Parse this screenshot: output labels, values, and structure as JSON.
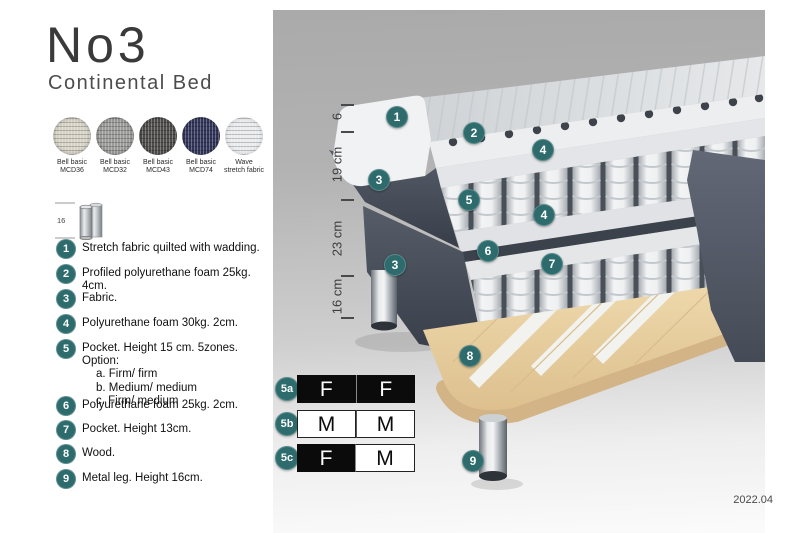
{
  "title": "No3",
  "subtitle": "Continental Bed",
  "swatches": [
    {
      "line1": "Bell basic",
      "line2": "MCD36",
      "color": "#d6d2c6"
    },
    {
      "line1": "Bell basic",
      "line2": "MCD32",
      "color": "#9b9b99"
    },
    {
      "line1": "Bell basic",
      "line2": "MCD43",
      "color": "#4e4d4b"
    },
    {
      "line1": "Bell basic",
      "line2": "MCD74",
      "color": "#33365a"
    },
    {
      "line1": "Wave",
      "line2": "stretch fabric",
      "color": "#e9ebee"
    }
  ],
  "leg_icon": {
    "dimension": "16"
  },
  "legend": [
    {
      "num": "1",
      "text": "Stretch fabric quilted with wadding."
    },
    {
      "num": "2",
      "text": "Profiled polyurethane foam 25kg. 4cm."
    },
    {
      "num": "3",
      "text": "Fabric."
    },
    {
      "num": "4",
      "text": "Polyurethane foam 30kg. 2cm."
    },
    {
      "num": "5",
      "text": "Pocket. Height 15 cm. 5zones. Option:",
      "options": [
        "a. Firm/ firm",
        "b. Medium/ medium",
        "c. Firm/ medium"
      ]
    },
    {
      "num": "6",
      "text": "Polyurethane foam 25kg. 2cm."
    },
    {
      "num": "7",
      "text": "Pocket. Height 13cm."
    },
    {
      "num": "8",
      "text": "Wood."
    },
    {
      "num": "9",
      "text": "Metal leg. Height 16cm."
    }
  ],
  "dimensions": [
    "6",
    "19 cm",
    "23 cm",
    "16 cm"
  ],
  "diagram": {
    "badges": [
      "1",
      "2",
      "4",
      "3",
      "5",
      "4",
      "6",
      "3",
      "7",
      "8",
      "9"
    ]
  },
  "firmness": {
    "rows": [
      {
        "label": "5a",
        "cells": [
          {
            "text": "F",
            "style": "dark"
          },
          {
            "text": "F",
            "style": "dark"
          }
        ]
      },
      {
        "label": "5b",
        "cells": [
          {
            "text": "M",
            "style": "light"
          },
          {
            "text": "M",
            "style": "light"
          }
        ]
      },
      {
        "label": "5c",
        "cells": [
          {
            "text": "F",
            "style": "dark"
          },
          {
            "text": "M",
            "style": "light"
          }
        ]
      }
    ]
  },
  "version": "2022.04",
  "colors": {
    "badge_teal": "#2d6b6d",
    "fabric_slate": "#4a505c",
    "wood": "#e6cda0",
    "panel_gray_top": "#aaaaaa",
    "table_dark": "#0b0b0b"
  }
}
